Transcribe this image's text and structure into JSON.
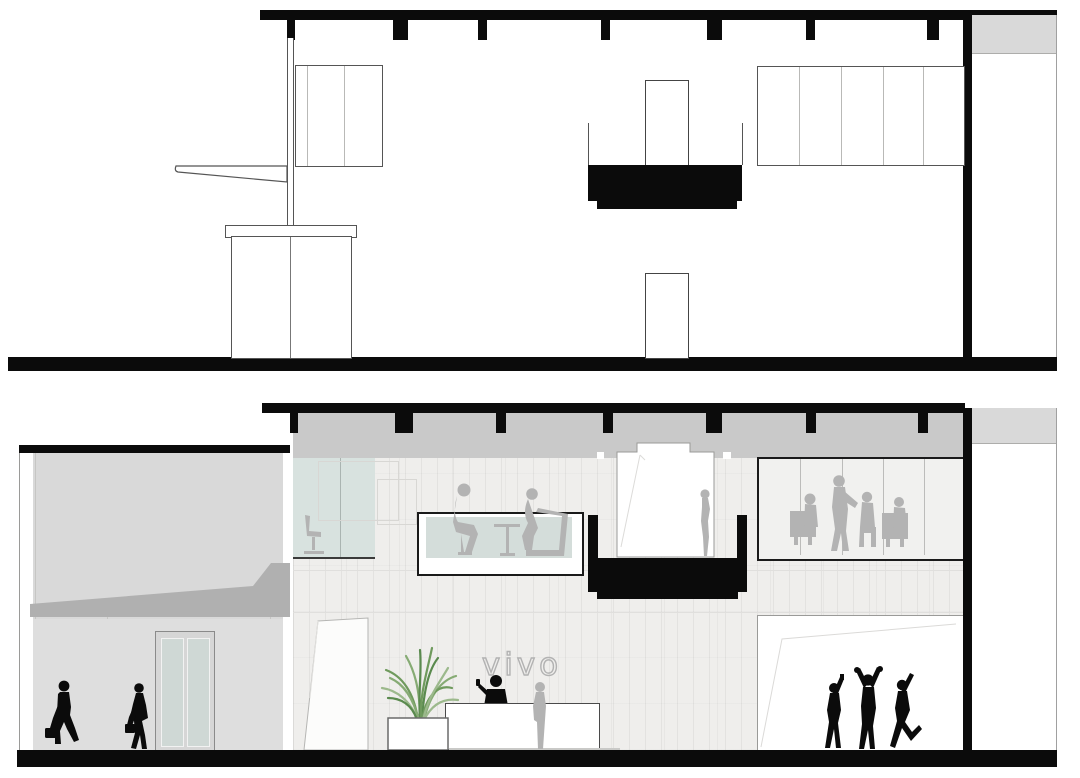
{
  "title": "vivo retail store — building section drawings",
  "logo": {
    "text": "vivo"
  },
  "palette": {
    "black": "#0b0b0b",
    "slab": "#c9c9c9",
    "facade": "#d9d9d9",
    "canopy": "#b0b0b0",
    "wall": "#efeeec",
    "glass": "#d8e2df",
    "sil": "#b3b3b3",
    "logo": "#b2b2b2",
    "line": "#555555"
  }
}
